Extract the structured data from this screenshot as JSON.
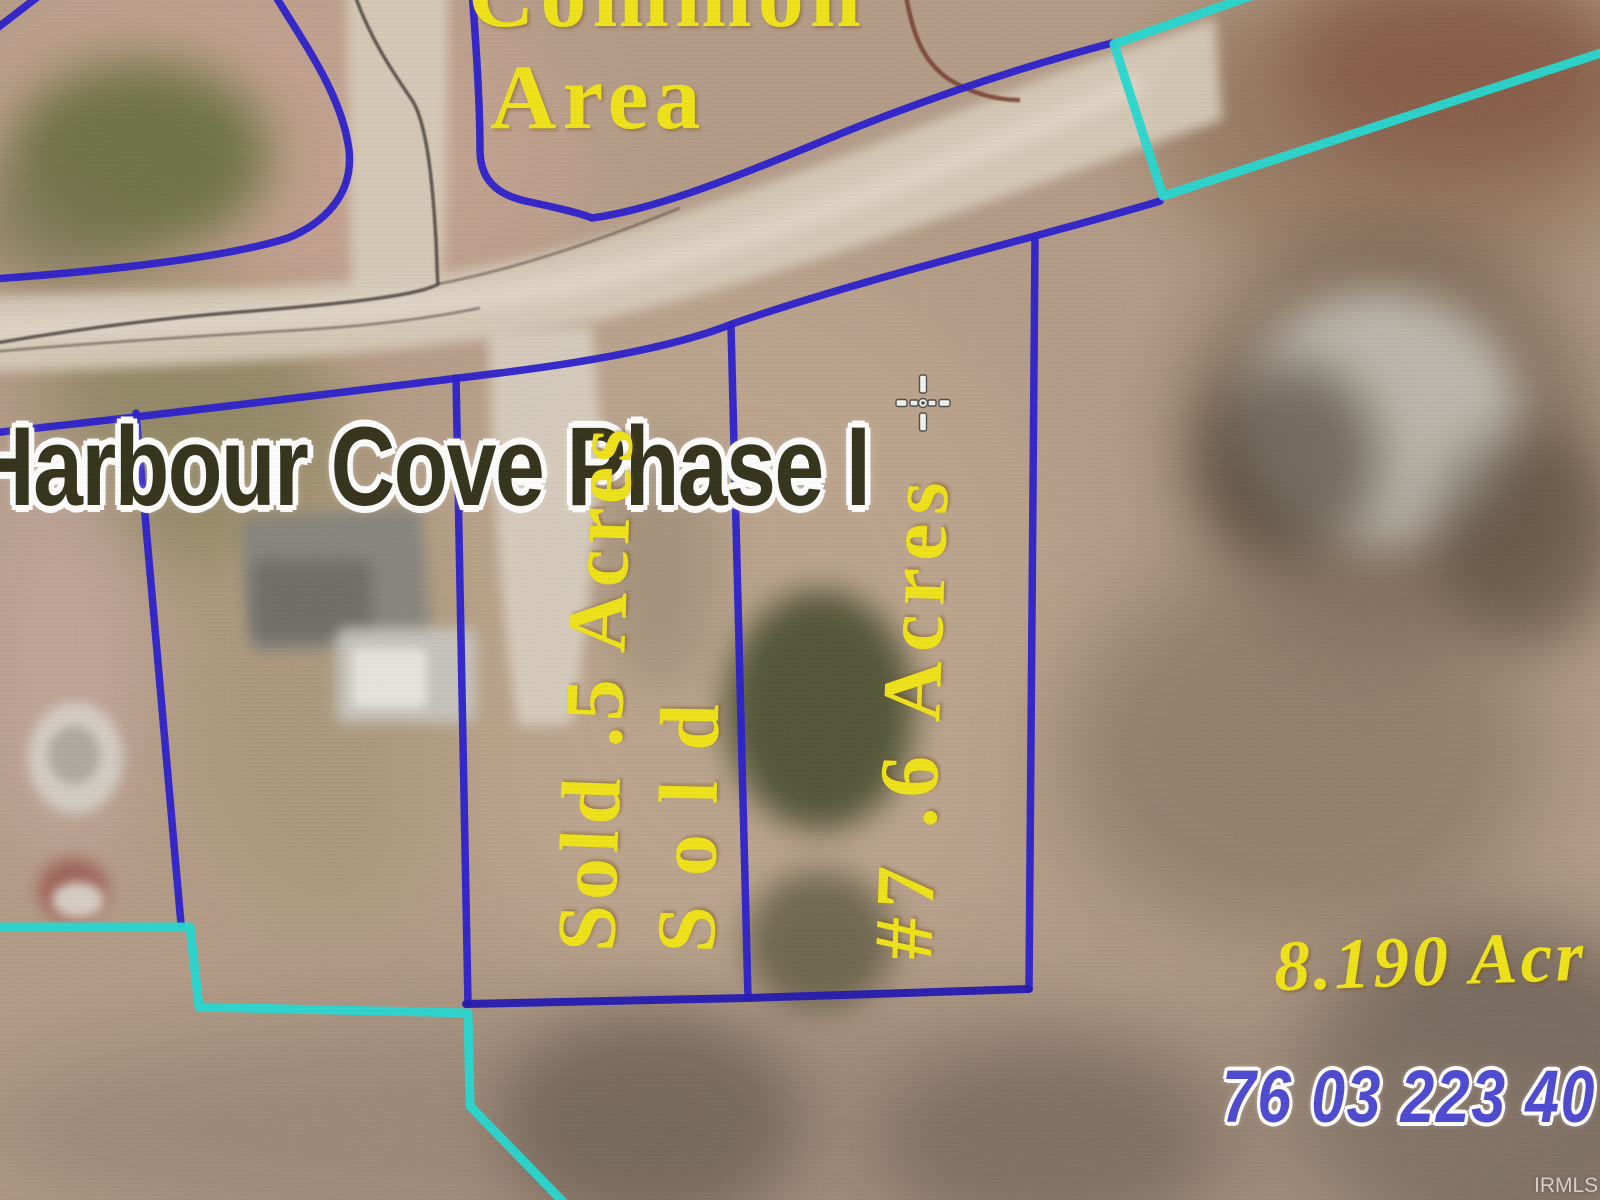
{
  "colors": {
    "plat_blue": "#2518cc",
    "plat_blue_dark": "#1c12b0",
    "boundary_cyan": "#1fd9d2",
    "label_yellow": "#f0e413",
    "title_olive": "#2e2d15",
    "parcel_blue": "#4845d2"
  },
  "map": {
    "common_area": {
      "line1": "Common",
      "line2": "Area"
    },
    "subdivision_title": "Harbour Cove Phase I",
    "lots": [
      {
        "label": "Sold .5 Acres",
        "status": "sold"
      },
      {
        "label": "Sold",
        "status": "sold"
      },
      {
        "label": "#7 .6 Acres",
        "lot_number": "#7"
      }
    ],
    "east_parcel": {
      "acreage": "8.190 Acr",
      "parcel_id": "76 03 223 40"
    },
    "watermark": "IRMLS"
  }
}
